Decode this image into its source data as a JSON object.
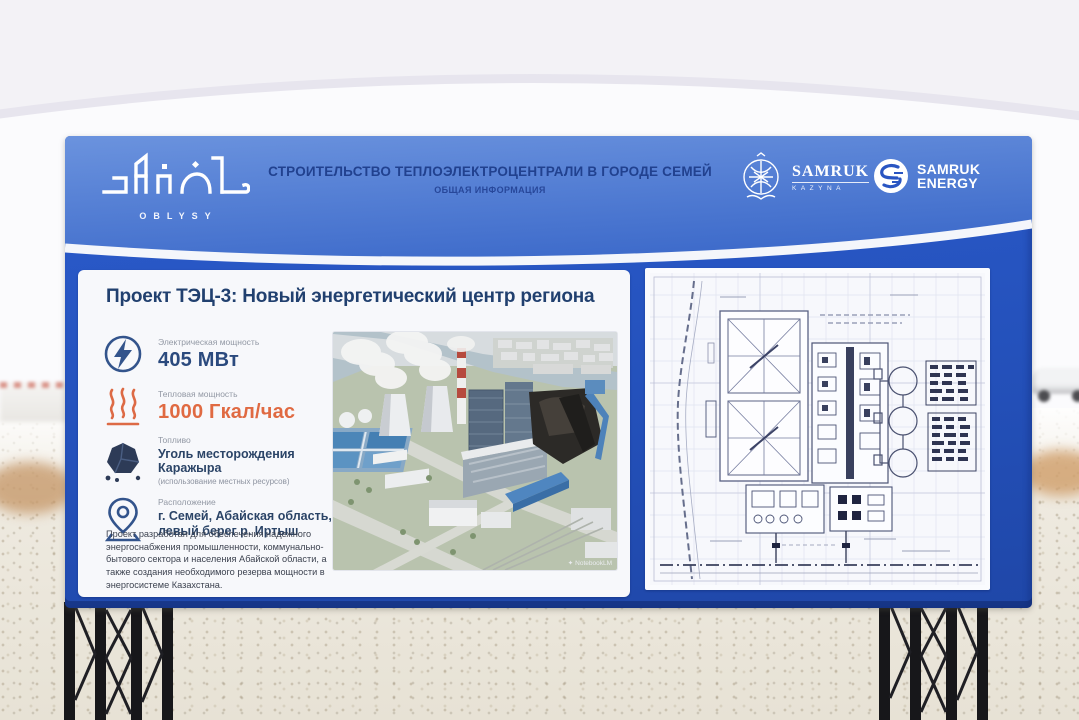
{
  "header": {
    "region_logo": {
      "title": "Abai",
      "subtitle": "OBLYSY"
    },
    "title": "СТРОИТЕЛЬСТВО ТЕПЛОЭЛЕКТРОЦЕНТРАЛИ В ГОРОДЕ СЕМЕЙ",
    "subtitle": "ОБЩАЯ ИНФОРМАЦИЯ",
    "logos": {
      "samruk_kazyna": {
        "line1": "SAMRUK",
        "line2": "KAZYNA"
      },
      "samruk_energy": {
        "line1": "SAMRUK",
        "line2": "ENERGY"
      }
    }
  },
  "info_panel": {
    "heading": "Проект ТЭЦ-3: Новый энергетический центр региона",
    "stats": [
      {
        "icon": "lightning-icon",
        "label": "Электрическая мощность",
        "value": "405 МВт"
      },
      {
        "icon": "heat-icon",
        "label": "Тепловая мощность",
        "value": "1000 Гкал/час"
      },
      {
        "icon": "coal-icon",
        "label": "Топливо",
        "value": "Уголь месторождения Каражыра",
        "note": "(использование местных ресурсов)"
      },
      {
        "icon": "location-pin-icon",
        "label": "Расположение",
        "value": "г. Семей, Абайская область, левый берег р. Иртыш"
      }
    ],
    "description": "Проект разработан для обеспечения надежного энергоснабжения промышленности, коммунально-бытового сектора и населения Абайской области, а также создания необходимого резерва мощности в энергосистеме Казахстана.",
    "render_watermark_icon": "✦",
    "render_watermark": "NotebookLM"
  },
  "colors": {
    "board_blue": "#2451bb",
    "header_blue": "#4a78d3",
    "accent_orange": "#e06a42",
    "navy_text": "#21406f"
  }
}
